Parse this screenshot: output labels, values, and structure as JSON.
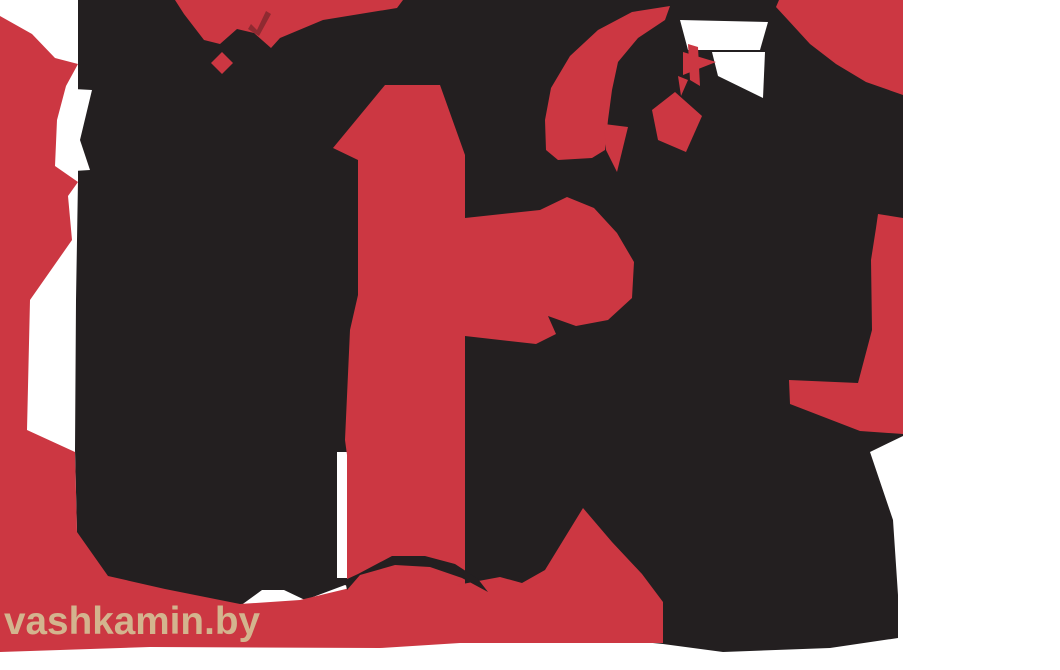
{
  "image": {
    "kind": "posterized-two-tone-photo",
    "description": "Abstract black and red posterized silhouette artwork with white background"
  },
  "watermark": {
    "text": "vashkamin.by"
  },
  "palette": {
    "background": "#ffffff",
    "ink": "#231f20",
    "red": "#cc3742",
    "dark_red": "#8f2a31",
    "tan": "#d3b48e"
  }
}
